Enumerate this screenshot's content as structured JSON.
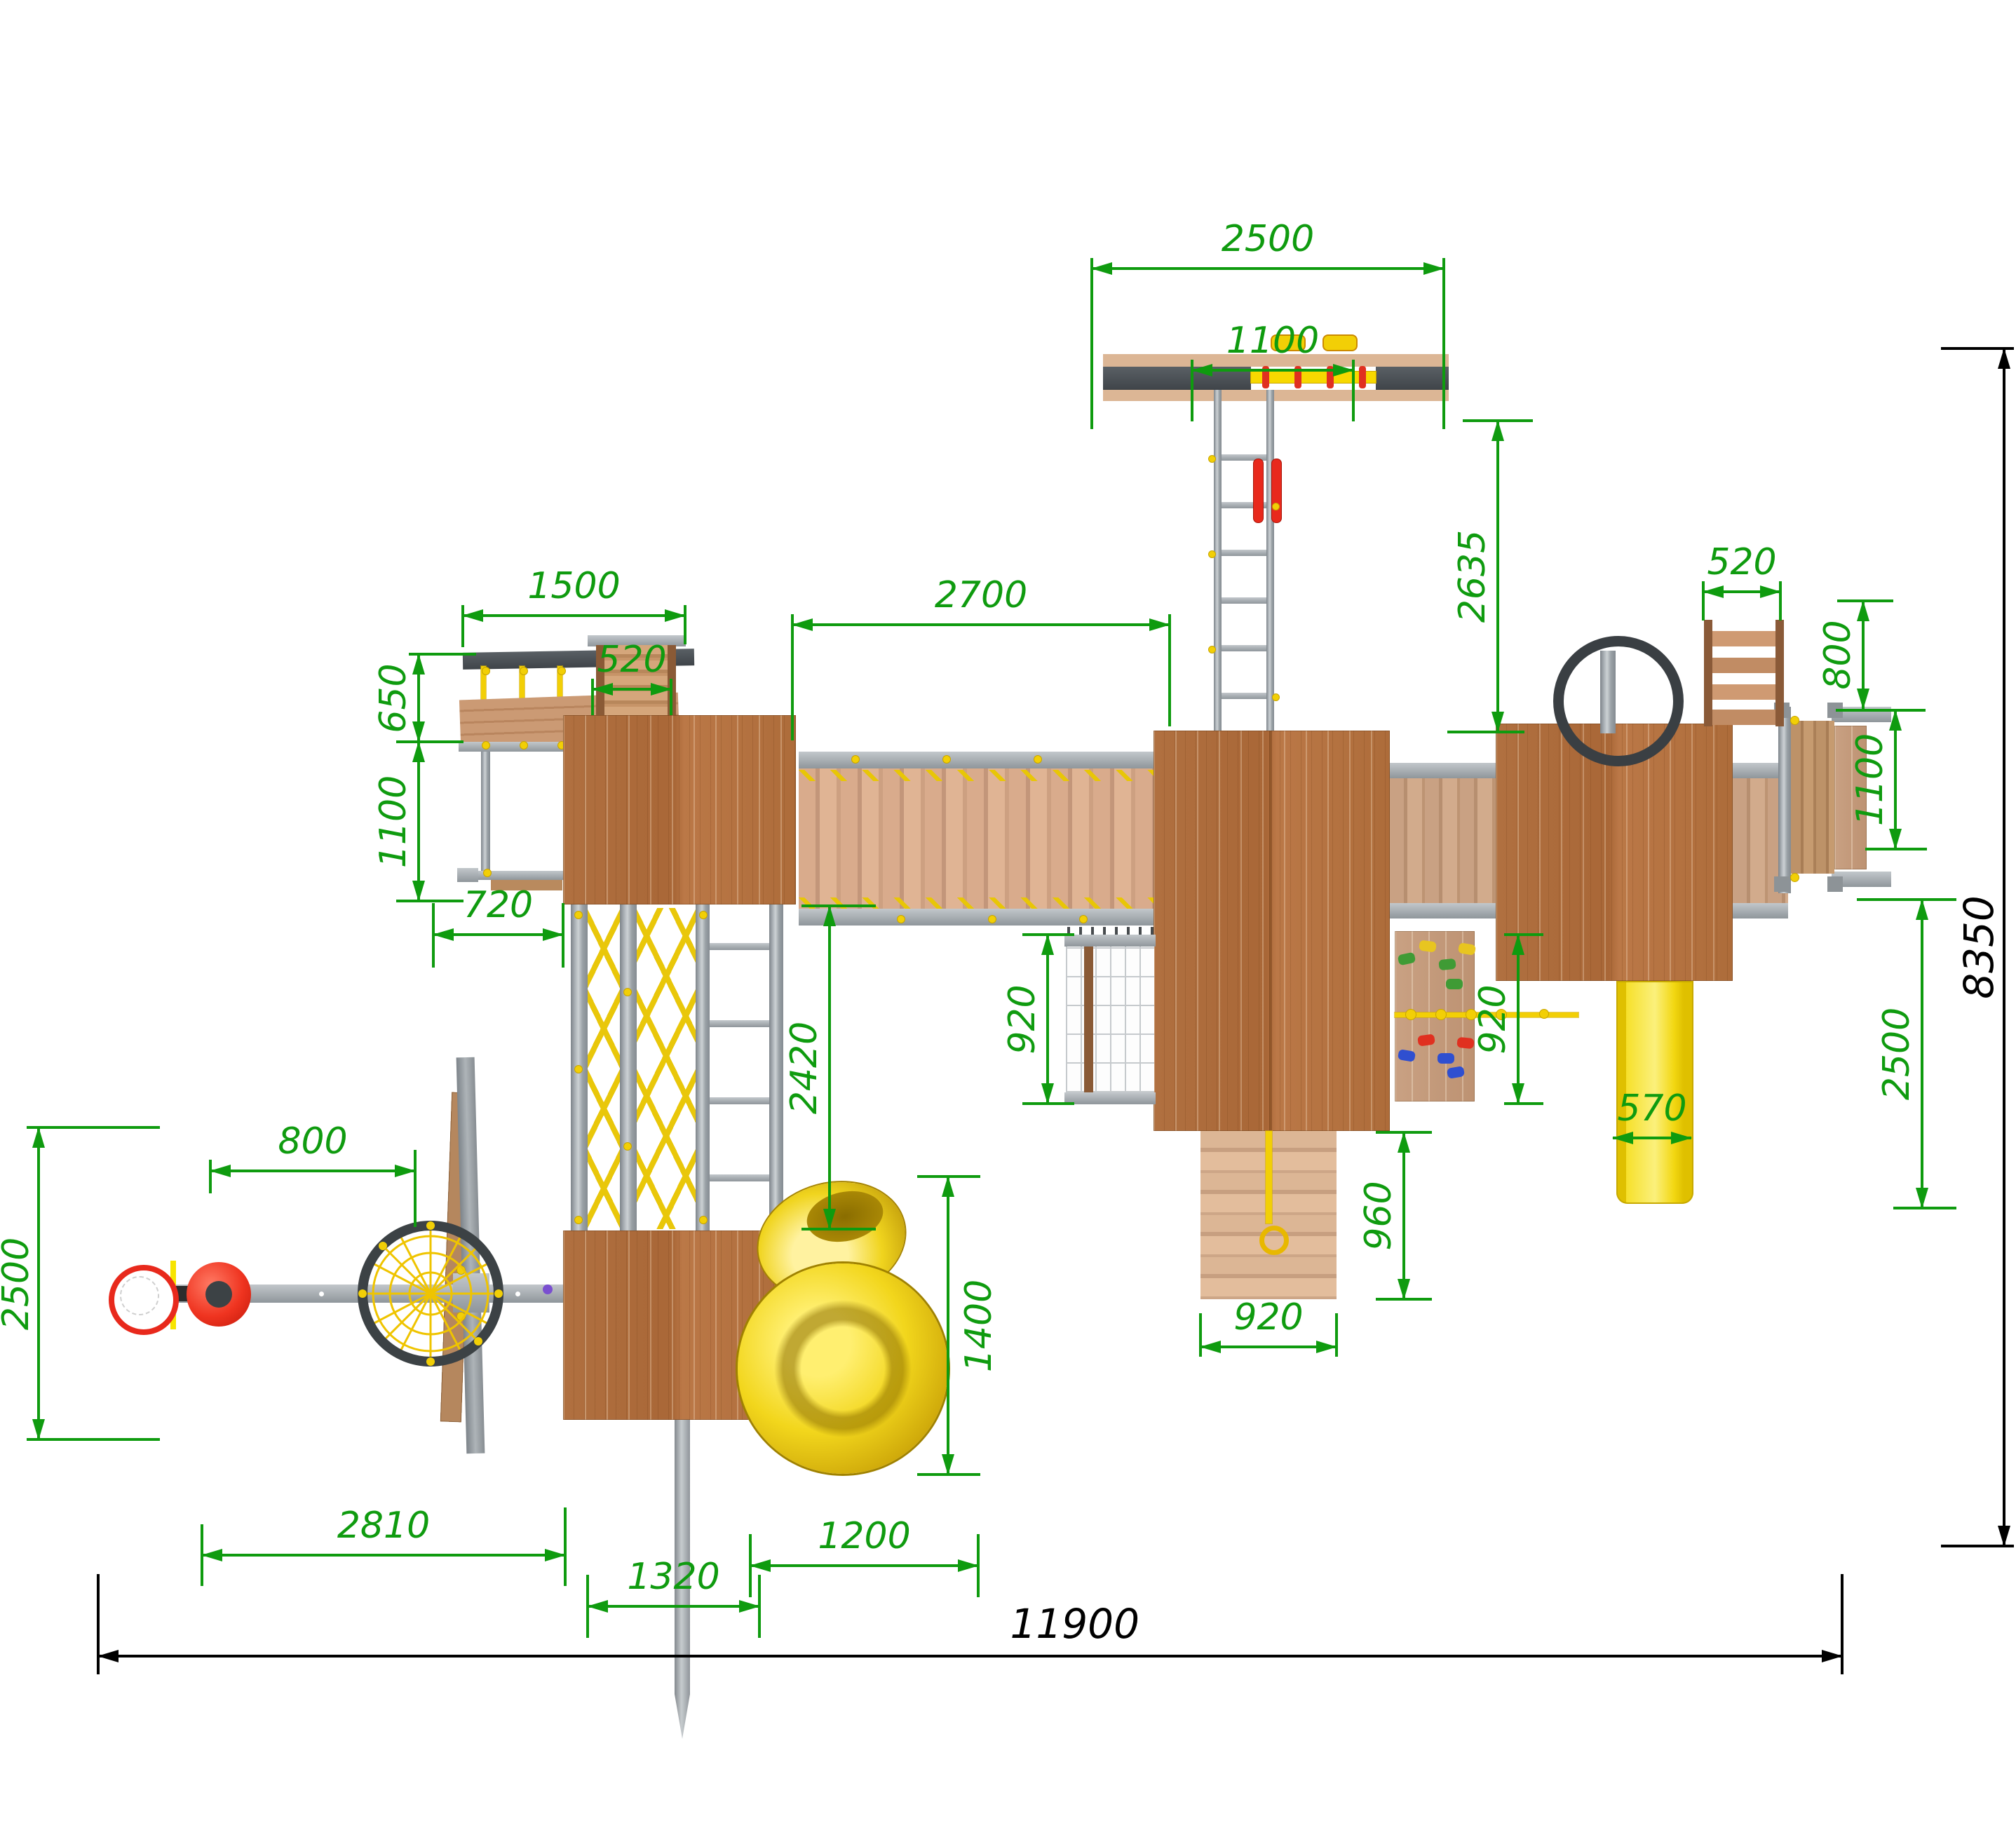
{
  "drawing": {
    "type": "playground-complex-top-view-plan",
    "units": "mm",
    "colors": {
      "dimension_green": "#0f9b0f",
      "overall_black": "#000000",
      "wood_brown": "#b07040",
      "metal_gray": "#9aa0a5",
      "slide_yellow": "#f5d90a",
      "accent_red": "#e8291c"
    },
    "overall": {
      "width": "11900",
      "depth": "8350"
    },
    "dims": {
      "swing_beam_width": "2500",
      "swing_inner_span": "1100",
      "swing_ladder_run": "2635",
      "left_unit_width": "1500",
      "left_stairs_width": "520",
      "bridge_length": "2700",
      "rope_climb_depth": "650",
      "left_frame_depth": "1100",
      "left_frame_offset": "720",
      "climb_section_run": "2420",
      "net_depth": "920",
      "holds_wall_depth": "920",
      "ramp_run": "960",
      "ramp_width": "920",
      "spiral_slide_depth": "1400",
      "slide_exit_clearance": "1200",
      "lower_tower_width": "1320",
      "hoop_offset": "800",
      "arm_clearance_depth": "2500",
      "arm_length": "2810",
      "right_ladder_width": "520",
      "right_ladder_extension": "800",
      "end_platform_depth": "1100",
      "straight_slide_width": "570",
      "straight_slide_clearance": "2500"
    }
  }
}
